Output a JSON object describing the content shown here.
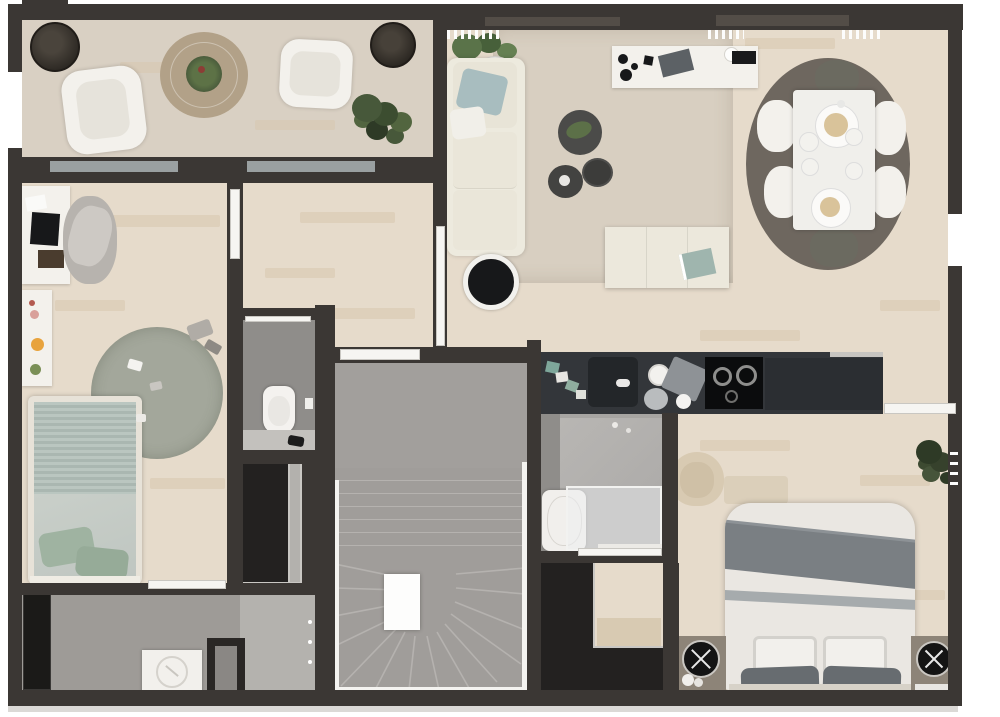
{
  "meta": {
    "type": "3d-floor-plan-render",
    "view": "top-down",
    "level": "apartment floor with staircase"
  },
  "palette": {
    "wall": "#3b3734",
    "wood": "#e6dbcb",
    "wood_streak": "#d7c6af",
    "terrace": "#d9d0c3",
    "tile": "#a09d98",
    "wc_tile": "#8f8d8a",
    "stair": "#9d9a97",
    "stair_step": "#b5b2af",
    "rug": "#d8cfc1",
    "rug_dining": "#6e675f",
    "rug_round": "#a3a79b",
    "sofa": "#edeade",
    "cream": "#ece8dc",
    "white": "#f3f1ec",
    "black": "#17181a",
    "counter": "#33363a",
    "counter2": "#2b2e32",
    "cooktop": "#0b0c0d",
    "bed_white": "#eae7e2",
    "bed_band": "#7a7f83",
    "blanket": "#b5c2bc",
    "pillow": "#9fb3a1",
    "plant": "#47583a",
    "plant_dark": "#2e3a26",
    "table_wood": "#b2a188",
    "beige": "#d8cab2",
    "glass": "#c9cdd0",
    "door": "#f6f5f2",
    "sill": "#9aa0a1",
    "closet_black": "#232120",
    "frame_gray": "#c9c7c3"
  },
  "rooms": [
    {
      "id": "terrace",
      "label": "terrace-balcony",
      "furniture": [
        "planter-pot",
        "armchair",
        "round-coffee-table",
        "table-plant",
        "armchair",
        "potted-plant",
        "planter-pot"
      ]
    },
    {
      "id": "living-dining",
      "label": "living-dining-room",
      "furniture": [
        "potted-plant",
        "sofa",
        "throw-pillows",
        "area-rug",
        "console-table",
        "decor-vases",
        "coffee-table-set-3",
        "round-side-table",
        "sideboard",
        "dining-rug",
        "dining-table",
        "place-settings",
        "side-chair-white-x4",
        "end-chair-dark-x2"
      ]
    },
    {
      "id": "kitchen",
      "label": "kitchen-counter",
      "furniture": [
        "dish-set",
        "sink",
        "faucet",
        "plate-stack",
        "dish-towel",
        "cooktop",
        "base-cabinets"
      ]
    },
    {
      "id": "nursery",
      "label": "child-bedroom",
      "furniture": [
        "desk",
        "laptop",
        "desk-chair",
        "wall-shelf",
        "single-bed",
        "pillows",
        "round-rug",
        "toys"
      ]
    },
    {
      "id": "wc",
      "label": "wc",
      "furniture": [
        "toilet",
        "vanity-counter",
        "faucet"
      ]
    },
    {
      "id": "closet",
      "label": "built-in-closet",
      "furniture": [
        "wardrobe"
      ]
    },
    {
      "id": "laundry",
      "label": "utility-entry",
      "furniture": [
        "tall-cabinet",
        "washing-machine",
        "entry-door",
        "floor-mat"
      ]
    },
    {
      "id": "stairwell",
      "label": "staircase",
      "furniture": [
        "winder-stairs",
        "railing",
        "newel-post"
      ]
    },
    {
      "id": "bathroom",
      "label": "shower-room",
      "furniture": [
        "washbasin-unit",
        "glass-shower"
      ]
    },
    {
      "id": "wardrobe",
      "label": "bedroom-wardrobe",
      "furniture": [
        "l-shaped-wardrobe",
        "bench"
      ]
    },
    {
      "id": "bedroom",
      "label": "master-bedroom",
      "furniture": [
        "double-bed",
        "pillows",
        "nightstand-x2",
        "round-tray-x2",
        "armchair",
        "bench",
        "potted-plant",
        "radiator"
      ]
    }
  ]
}
